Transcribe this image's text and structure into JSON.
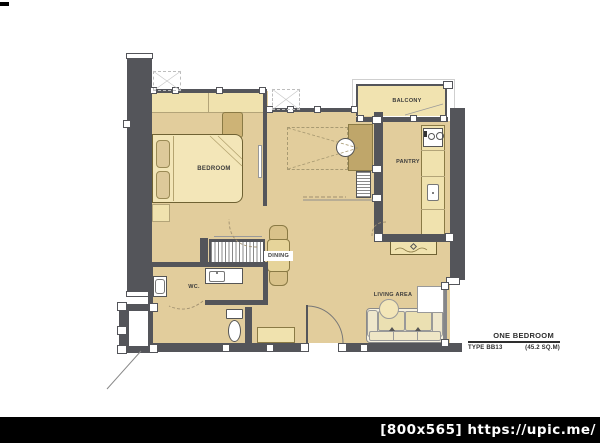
{
  "footer": {
    "watermark": "[800x565] https://upic.me/"
  },
  "title_block": {
    "title": "ONE BEDROOM",
    "type_code": "TYPE BB13",
    "area": "(45.2 SQ.M)"
  },
  "rooms": {
    "bedroom": {
      "label": "BEDROOM"
    },
    "balcony": {
      "label": "BALCONY"
    },
    "pantry": {
      "label": "PANTRY"
    },
    "dining": {
      "label": "DINING"
    },
    "wc": {
      "label": "WC."
    },
    "living": {
      "label": "LIVING AREA"
    }
  },
  "colors": {
    "floor": "#e2cd9c",
    "floor_light": "#f1e3b0",
    "wall": "#54555a",
    "furniture": "#d9c28a",
    "footer_bg": "#000000",
    "footer_text": "#ffffff"
  }
}
